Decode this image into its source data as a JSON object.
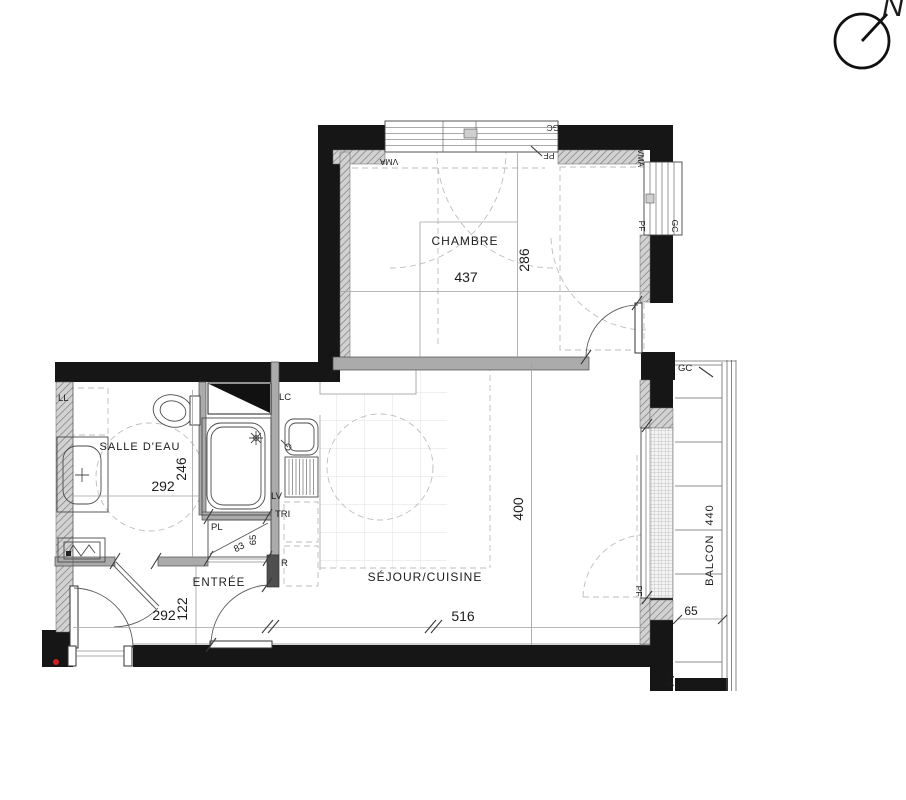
{
  "compass": {
    "north": "N"
  },
  "rooms": {
    "chambre": {
      "name": "CHAMBRE",
      "width": "437",
      "depth": "286"
    },
    "salle_deau": {
      "name": "SALLE D'EAU",
      "width": "292",
      "depth": "246"
    },
    "entree": {
      "name": "ENTRÉE",
      "width": "292",
      "depth": "122"
    },
    "sejour": {
      "name": "SÉJOUR/CUISINE",
      "width": "516",
      "depth": "400"
    },
    "balcon": {
      "name": "BALCON",
      "length": "440",
      "depth": "65",
      "screen_tag": "PV"
    }
  },
  "closet": {
    "tag": "PL",
    "diag_a": "83",
    "diag_b": "65"
  },
  "tags": {
    "washer": "LL",
    "duct": "LC",
    "dishwasher": "LV",
    "sorting": "TRI",
    "fridge": "R",
    "wall_mark": "C"
  },
  "windows": {
    "top": {
      "gc": "GC",
      "vma": "VMA",
      "pf": "PF"
    },
    "right": {
      "gc": "GC",
      "vma": "VMA",
      "pf": "PF"
    },
    "balcony_door": {
      "pf": "PF"
    },
    "balcony": {
      "gc": "GC"
    }
  },
  "colors": {
    "wall": "#161616",
    "partition": "#ababab",
    "dashes": "#bdbdbd",
    "red_marker": "#cc2020",
    "text": "#1c1c1c"
  }
}
